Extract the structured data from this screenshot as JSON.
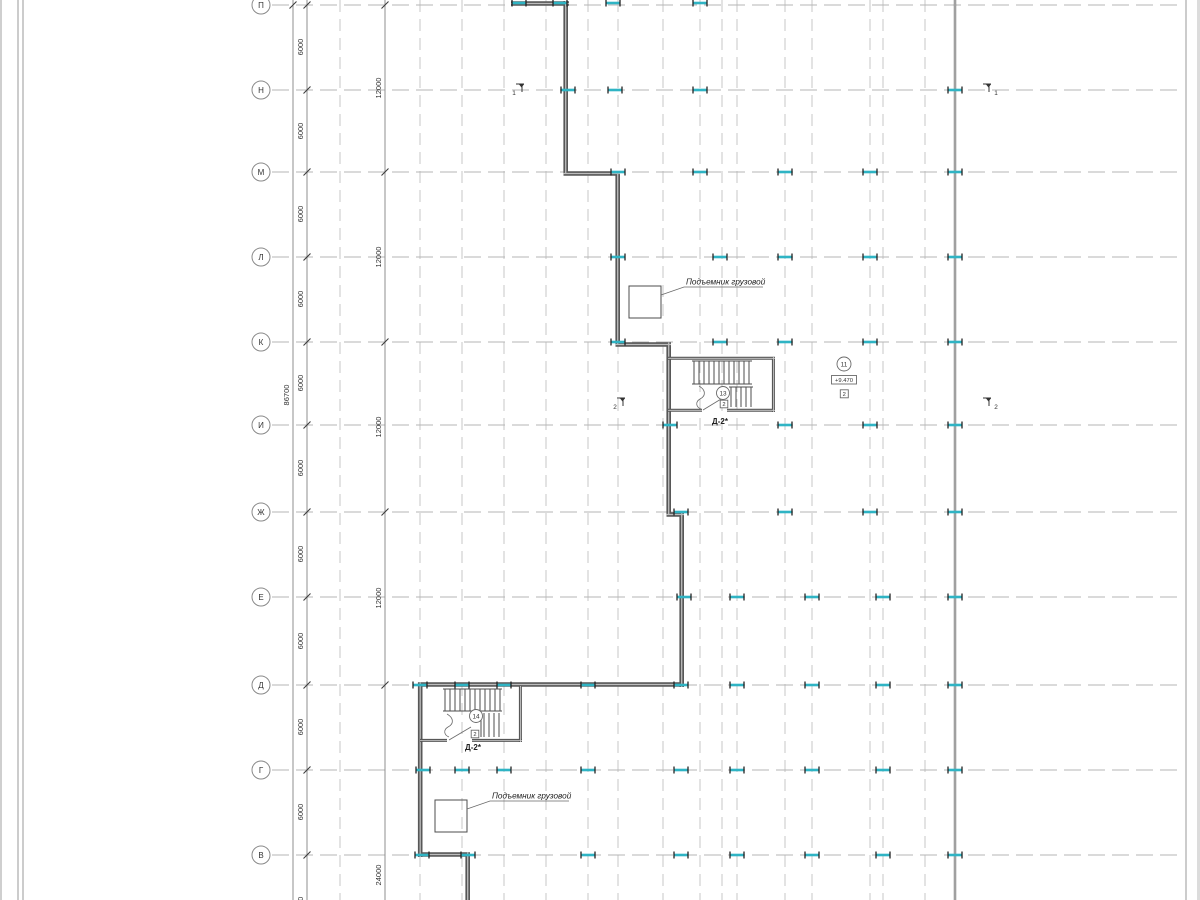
{
  "drawing": {
    "title_hint": "floor plan fragment",
    "axis_rows": [
      {
        "label": "П",
        "y": 5
      },
      {
        "label": "Н",
        "y": 90
      },
      {
        "label": "М",
        "y": 172
      },
      {
        "label": "Л",
        "y": 257
      },
      {
        "label": "К",
        "y": 342
      },
      {
        "label": "И",
        "y": 425
      },
      {
        "label": "Ж",
        "y": 512
      },
      {
        "label": "Е",
        "y": 597
      },
      {
        "label": "Д",
        "y": 685
      },
      {
        "label": "Г",
        "y": 770
      },
      {
        "label": "В",
        "y": 855
      }
    ],
    "grid_verticals_x": [
      340,
      420,
      462,
      504,
      546,
      588,
      618,
      663,
      700,
      722,
      737,
      785,
      812,
      870,
      883,
      925
    ],
    "dim_lines": {
      "total_x": 293,
      "bay_x": 307,
      "double_x": 385
    },
    "dim_labels": {
      "bays": [
        {
          "text": "6000",
          "y": 47
        },
        {
          "text": "6000",
          "y": 131
        },
        {
          "text": "6000",
          "y": 214
        },
        {
          "text": "6000",
          "y": 299
        },
        {
          "text": "6000",
          "y": 383
        },
        {
          "text": "6000",
          "y": 468
        },
        {
          "text": "6000",
          "y": 554
        },
        {
          "text": "6000",
          "y": 641
        },
        {
          "text": "6000",
          "y": 727
        },
        {
          "text": "6000",
          "y": 812
        }
      ],
      "bay_cut": {
        "text": "7200",
        "y": 905
      },
      "doubles": [
        {
          "text": "12000",
          "y": 88
        },
        {
          "text": "12000",
          "y": 257
        },
        {
          "text": "12000",
          "y": 427
        },
        {
          "text": "12000",
          "y": 598
        },
        {
          "text": "24000",
          "y": 875
        }
      ],
      "total": {
        "text": "86700",
        "y": 395
      }
    },
    "ticks": {
      "double_ys": [
        5,
        172,
        342,
        512,
        685
      ],
      "total_ys": [
        5
      ]
    },
    "columns_rows": [
      {
        "y": 3,
        "xs": [
          519,
          560,
          613,
          700
        ]
      },
      {
        "y": 90,
        "xs": [
          568,
          615,
          700,
          955
        ]
      },
      {
        "y": 172,
        "xs": [
          618,
          700,
          785,
          870,
          955
        ]
      },
      {
        "y": 257,
        "xs": [
          618,
          720,
          785,
          870,
          955
        ]
      },
      {
        "y": 342,
        "xs": [
          618,
          720,
          785,
          870,
          955
        ]
      },
      {
        "y": 425,
        "xs": [
          670,
          785,
          870,
          955
        ]
      },
      {
        "y": 512,
        "xs": [
          681,
          785,
          870,
          955
        ]
      },
      {
        "y": 597,
        "xs": [
          684,
          737,
          812,
          883,
          955
        ]
      },
      {
        "y": 685,
        "xs": [
          420,
          462,
          504,
          588,
          681,
          737,
          812,
          883,
          955
        ]
      },
      {
        "y": 770,
        "xs": [
          423,
          462,
          504,
          588,
          681,
          737,
          812,
          883,
          955
        ]
      },
      {
        "y": 855,
        "xs": [
          422,
          468,
          588,
          681,
          737,
          812,
          883,
          955
        ]
      }
    ],
    "section_marks": [
      {
        "num": "1",
        "x": 520,
        "y": 87,
        "side": "left"
      },
      {
        "num": "1",
        "x": 987,
        "y": 87,
        "side": "right"
      },
      {
        "num": "2",
        "x": 621,
        "y": 401,
        "side": "left"
      },
      {
        "num": "2",
        "x": 987,
        "y": 401,
        "side": "right"
      }
    ],
    "stairs": [
      {
        "circle": "13",
        "box": "2",
        "label": "Д-2*"
      },
      {
        "circle": "14",
        "box": "2",
        "label": "Д-2*"
      }
    ],
    "level_mark": {
      "circle": "11",
      "elevation": "+9.470",
      "box": "2"
    },
    "elevators": [
      {
        "label": "Подъемник грузовой"
      },
      {
        "label": "Подъемник грузовой"
      }
    ],
    "colors": {
      "column": "#2fb4c4",
      "wall": "#575757",
      "grid": "#b8b8b8",
      "dim_text": "#333333"
    }
  }
}
